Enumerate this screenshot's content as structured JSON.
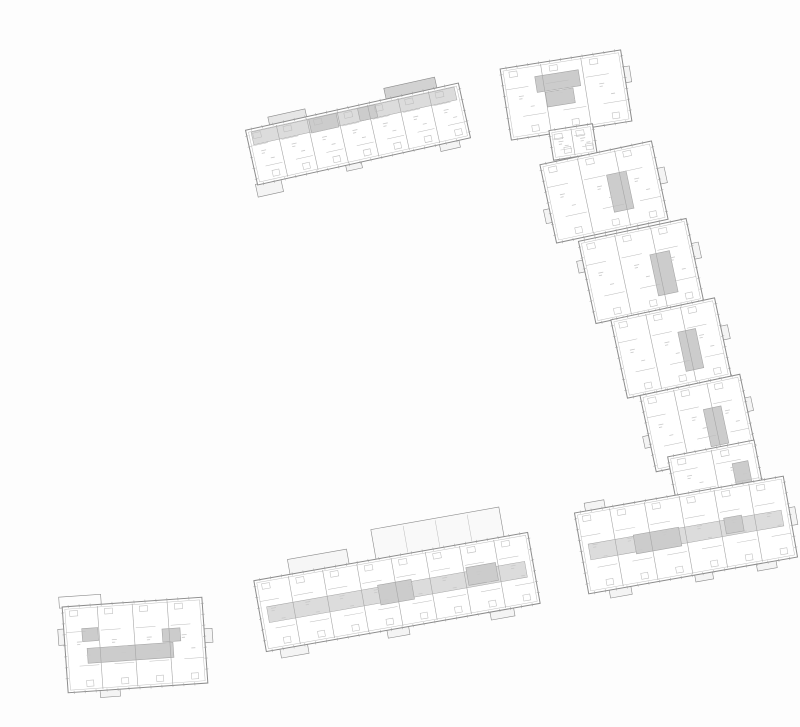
{
  "drawing": {
    "width": 800,
    "height": 727,
    "background": "#fdfdfd",
    "palette": {
      "wall": "#8c8c8c",
      "mid": "#a6a6a6",
      "thin": "#bdbdbd",
      "tick": "#a0a0a0",
      "speck": "#c9c9c9",
      "fillMid": "#dcdcdc",
      "fillDark": "#cccccc",
      "paper": "#ffffff"
    },
    "blocks": [
      {
        "id": "north-band",
        "cx": 358,
        "cy": 134,
        "rot": -12.5,
        "len": 218,
        "wid": 56,
        "units": 7,
        "corridor": "top",
        "cores": [
          [
            -45,
            -25,
            28,
            14
          ],
          [
            5,
            -25,
            18,
            13
          ]
        ],
        "bumps": [
          {
            "e": "top",
            "at": 0.2,
            "len": 38,
            "d": 8,
            "fill": "#e6e6e6"
          },
          {
            "e": "top",
            "at": 0.78,
            "len": 52,
            "d": 11,
            "fill": "#d2d2d2"
          },
          {
            "e": "bottom",
            "at": 0.05,
            "len": 26,
            "d": 12
          },
          {
            "e": "bottom",
            "at": 0.45,
            "len": 16,
            "d": 6
          },
          {
            "e": "bottom",
            "at": 0.9,
            "len": 20,
            "d": 7
          }
        ]
      },
      {
        "id": "east-chain-1",
        "cx": 566,
        "cy": 95,
        "rot": -9,
        "len": 122,
        "wid": 72,
        "units": 3,
        "cores": [
          [
            -28,
            -23,
            44,
            16
          ],
          [
            -20,
            -6,
            28,
            15
          ]
        ],
        "bumps": [
          {
            "e": "right",
            "at": 0.35,
            "len": 16,
            "d": 6
          }
        ]
      },
      {
        "id": "east-chain-link",
        "cx": 573,
        "cy": 142,
        "rot": -9,
        "len": 44,
        "wid": 30,
        "units": 2,
        "cores": []
      },
      {
        "id": "east-chain-2",
        "cx": 604,
        "cy": 192,
        "rot": -12,
        "len": 114,
        "wid": 80,
        "units": 3,
        "cores": [
          [
            6,
            -16,
            20,
            38
          ]
        ],
        "bumps": [
          {
            "e": "right",
            "at": 0.45,
            "len": 16,
            "d": 7
          },
          {
            "e": "left",
            "at": 0.65,
            "len": 14,
            "d": 6
          }
        ]
      },
      {
        "id": "east-chain-3",
        "cx": 641,
        "cy": 271,
        "rot": -12,
        "len": 110,
        "wid": 84,
        "units": 3,
        "cores": [
          [
            12,
            -14,
            20,
            42
          ]
        ],
        "bumps": [
          {
            "e": "right",
            "at": 0.4,
            "len": 16,
            "d": 7
          },
          {
            "e": "left",
            "at": 0.3,
            "len": 12,
            "d": 6
          }
        ]
      },
      {
        "id": "east-chain-4",
        "cx": 671,
        "cy": 348,
        "rot": -12,
        "len": 106,
        "wid": 80,
        "units": 3,
        "cores": [
          [
            10,
            -14,
            18,
            40
          ]
        ],
        "bumps": [
          {
            "e": "right",
            "at": 0.45,
            "len": 14,
            "d": 7
          }
        ]
      },
      {
        "id": "east-chain-5",
        "cx": 698,
        "cy": 423,
        "rot": -12,
        "len": 102,
        "wid": 78,
        "units": 3,
        "cores": [
          [
            8,
            -12,
            18,
            38
          ]
        ],
        "bumps": [
          {
            "e": "right",
            "at": 0.4,
            "len": 14,
            "d": 6
          },
          {
            "e": "left",
            "at": 0.6,
            "len": 12,
            "d": 6
          }
        ]
      },
      {
        "id": "east-chain-6",
        "cx": 716,
        "cy": 475,
        "rot": -11,
        "len": 88,
        "wid": 54,
        "units": 2,
        "cores": [
          [
            18,
            -8,
            16,
            24
          ]
        ]
      },
      {
        "id": "southeast-band",
        "cx": 686,
        "cy": 535,
        "rot": -10,
        "len": 212,
        "wid": 82,
        "units": 6,
        "corridor": "mid",
        "cores": [
          [
            -52,
            -9,
            46,
            19
          ],
          [
            40,
            -10,
            18,
            16
          ]
        ],
        "bumps": [
          {
            "e": "top",
            "at": 0.1,
            "len": 20,
            "d": 8
          },
          {
            "e": "bottom",
            "at": 0.15,
            "len": 22,
            "d": 8
          },
          {
            "e": "bottom",
            "at": 0.55,
            "len": 18,
            "d": 7
          },
          {
            "e": "bottom",
            "at": 0.85,
            "len": 20,
            "d": 7
          },
          {
            "e": "right",
            "at": 0.5,
            "len": 18,
            "d": 6
          }
        ]
      },
      {
        "id": "south-band",
        "cx": 397,
        "cy": 592,
        "rot": -10,
        "len": 278,
        "wid": 72,
        "units": 8,
        "corridor": "mid",
        "cores": [
          [
            -18,
            -10,
            34,
            20
          ],
          [
            72,
            -12,
            30,
            18
          ]
        ],
        "bumps": [
          {
            "e": "top",
            "at": 0.24,
            "len": 60,
            "d": 15,
            "fill": "#f6f6f6"
          },
          {
            "e": "top",
            "at": 0.68,
            "len": 130,
            "d": 30,
            "fill": "#f9f9f9"
          },
          {
            "e": "bottom",
            "at": 0.1,
            "len": 28,
            "d": 9
          },
          {
            "e": "bottom",
            "at": 0.48,
            "len": 22,
            "d": 8
          },
          {
            "e": "bottom",
            "at": 0.86,
            "len": 24,
            "d": 8
          }
        ]
      },
      {
        "id": "southwest-block",
        "cx": 135,
        "cy": 645,
        "rot": -4,
        "len": 140,
        "wid": 86,
        "units": 4,
        "cores": [
          [
            -48,
            0,
            86,
            15
          ],
          [
            -52,
            -20,
            16,
            13
          ],
          [
            28,
            -14,
            18,
            13
          ]
        ],
        "bumps": [
          {
            "e": "top",
            "at": 0.13,
            "len": 42,
            "d": 10,
            "fill": "#fdfdfd"
          },
          {
            "e": "bottom",
            "at": 0.3,
            "len": 20,
            "d": 7
          },
          {
            "e": "right",
            "at": 0.45,
            "len": 14,
            "d": 8
          },
          {
            "e": "left",
            "at": 0.35,
            "len": 16,
            "d": 6
          }
        ]
      }
    ]
  }
}
